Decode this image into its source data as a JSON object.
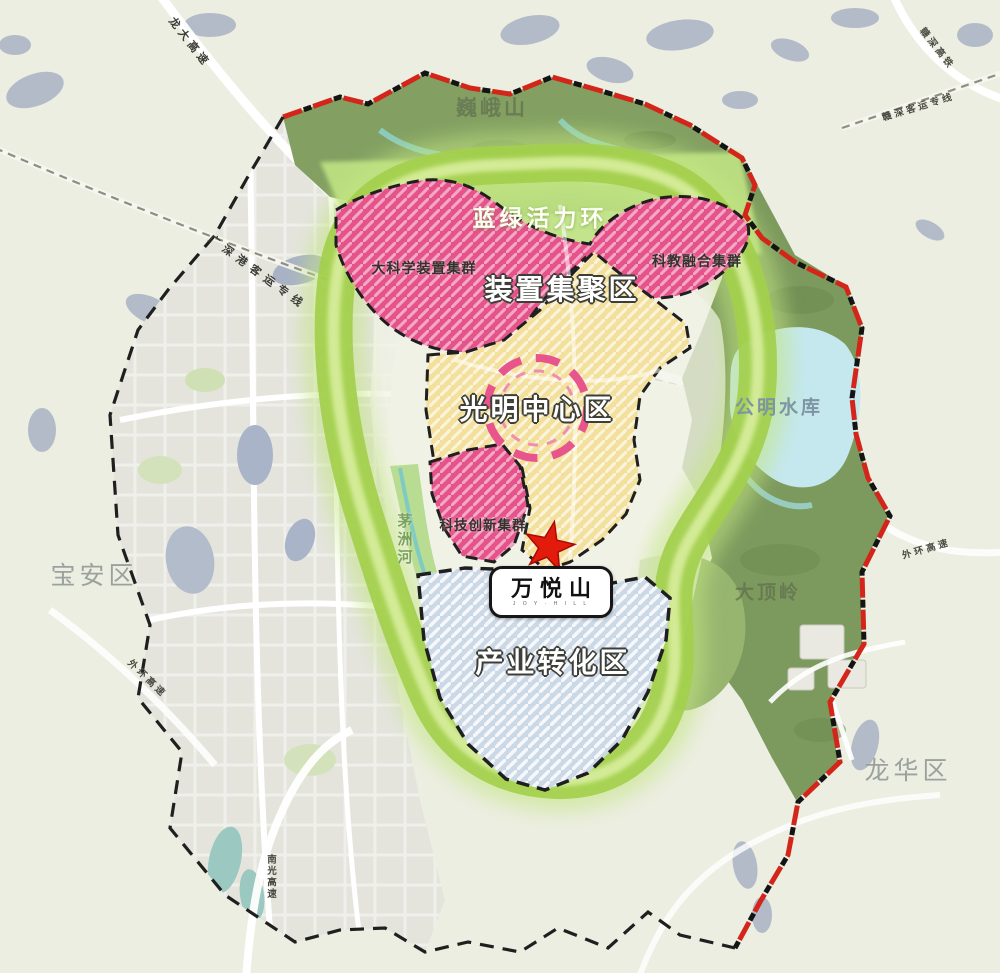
{
  "map_labels": {
    "weieshan": "巍峨山",
    "blue_green_ring": "蓝绿活力环",
    "big_science_cluster": "大科学装置集群",
    "device_cluster_zone": "装置集聚区",
    "sci_edu_cluster": "科教融合集群",
    "guangming_center": "光明中心区",
    "tech_innovation_cluster": "科技创新集群",
    "maozhou_river": "茅洲河",
    "industry_zone": "产业转化区",
    "gongming_reservoir": "公明水库",
    "dadingling": "大顶岭",
    "baoan_district": "宝安区",
    "longhua_district": "龙华区"
  },
  "marker": {
    "wanyueshan_title": "万悦山",
    "wanyueshan_sub": "J O Y · H I L L"
  },
  "roads": {
    "longda_expwy": "龙大高速",
    "gsg_passenger_line": "广深港客运专线",
    "ganshen_hsr": "赣深高铁",
    "ganshen_passenger_line": "赣深客运专线",
    "outer_ring_expwy_west": "外环高速",
    "outer_ring_expwy_east": "外环高速",
    "nanguang_expwy": "南光高速"
  },
  "colors": {
    "background": "#eceee1",
    "urban_gray": "#e4e4dd",
    "city_water": "#a9b2c4",
    "mountain_green": "#83a062",
    "forest_green": "#7d9a5e",
    "vitality_ring_green": "#a3cf4c",
    "zone_pink": "#e6538b",
    "zone_yellow": "#f3e09c",
    "zone_blue": "#cbd8e6",
    "reservoir_blue": "#c5e8ee",
    "boundary_red": "#d3251a",
    "boundary_black": "#1f1f1f",
    "star_red": "#e31b0c"
  }
}
